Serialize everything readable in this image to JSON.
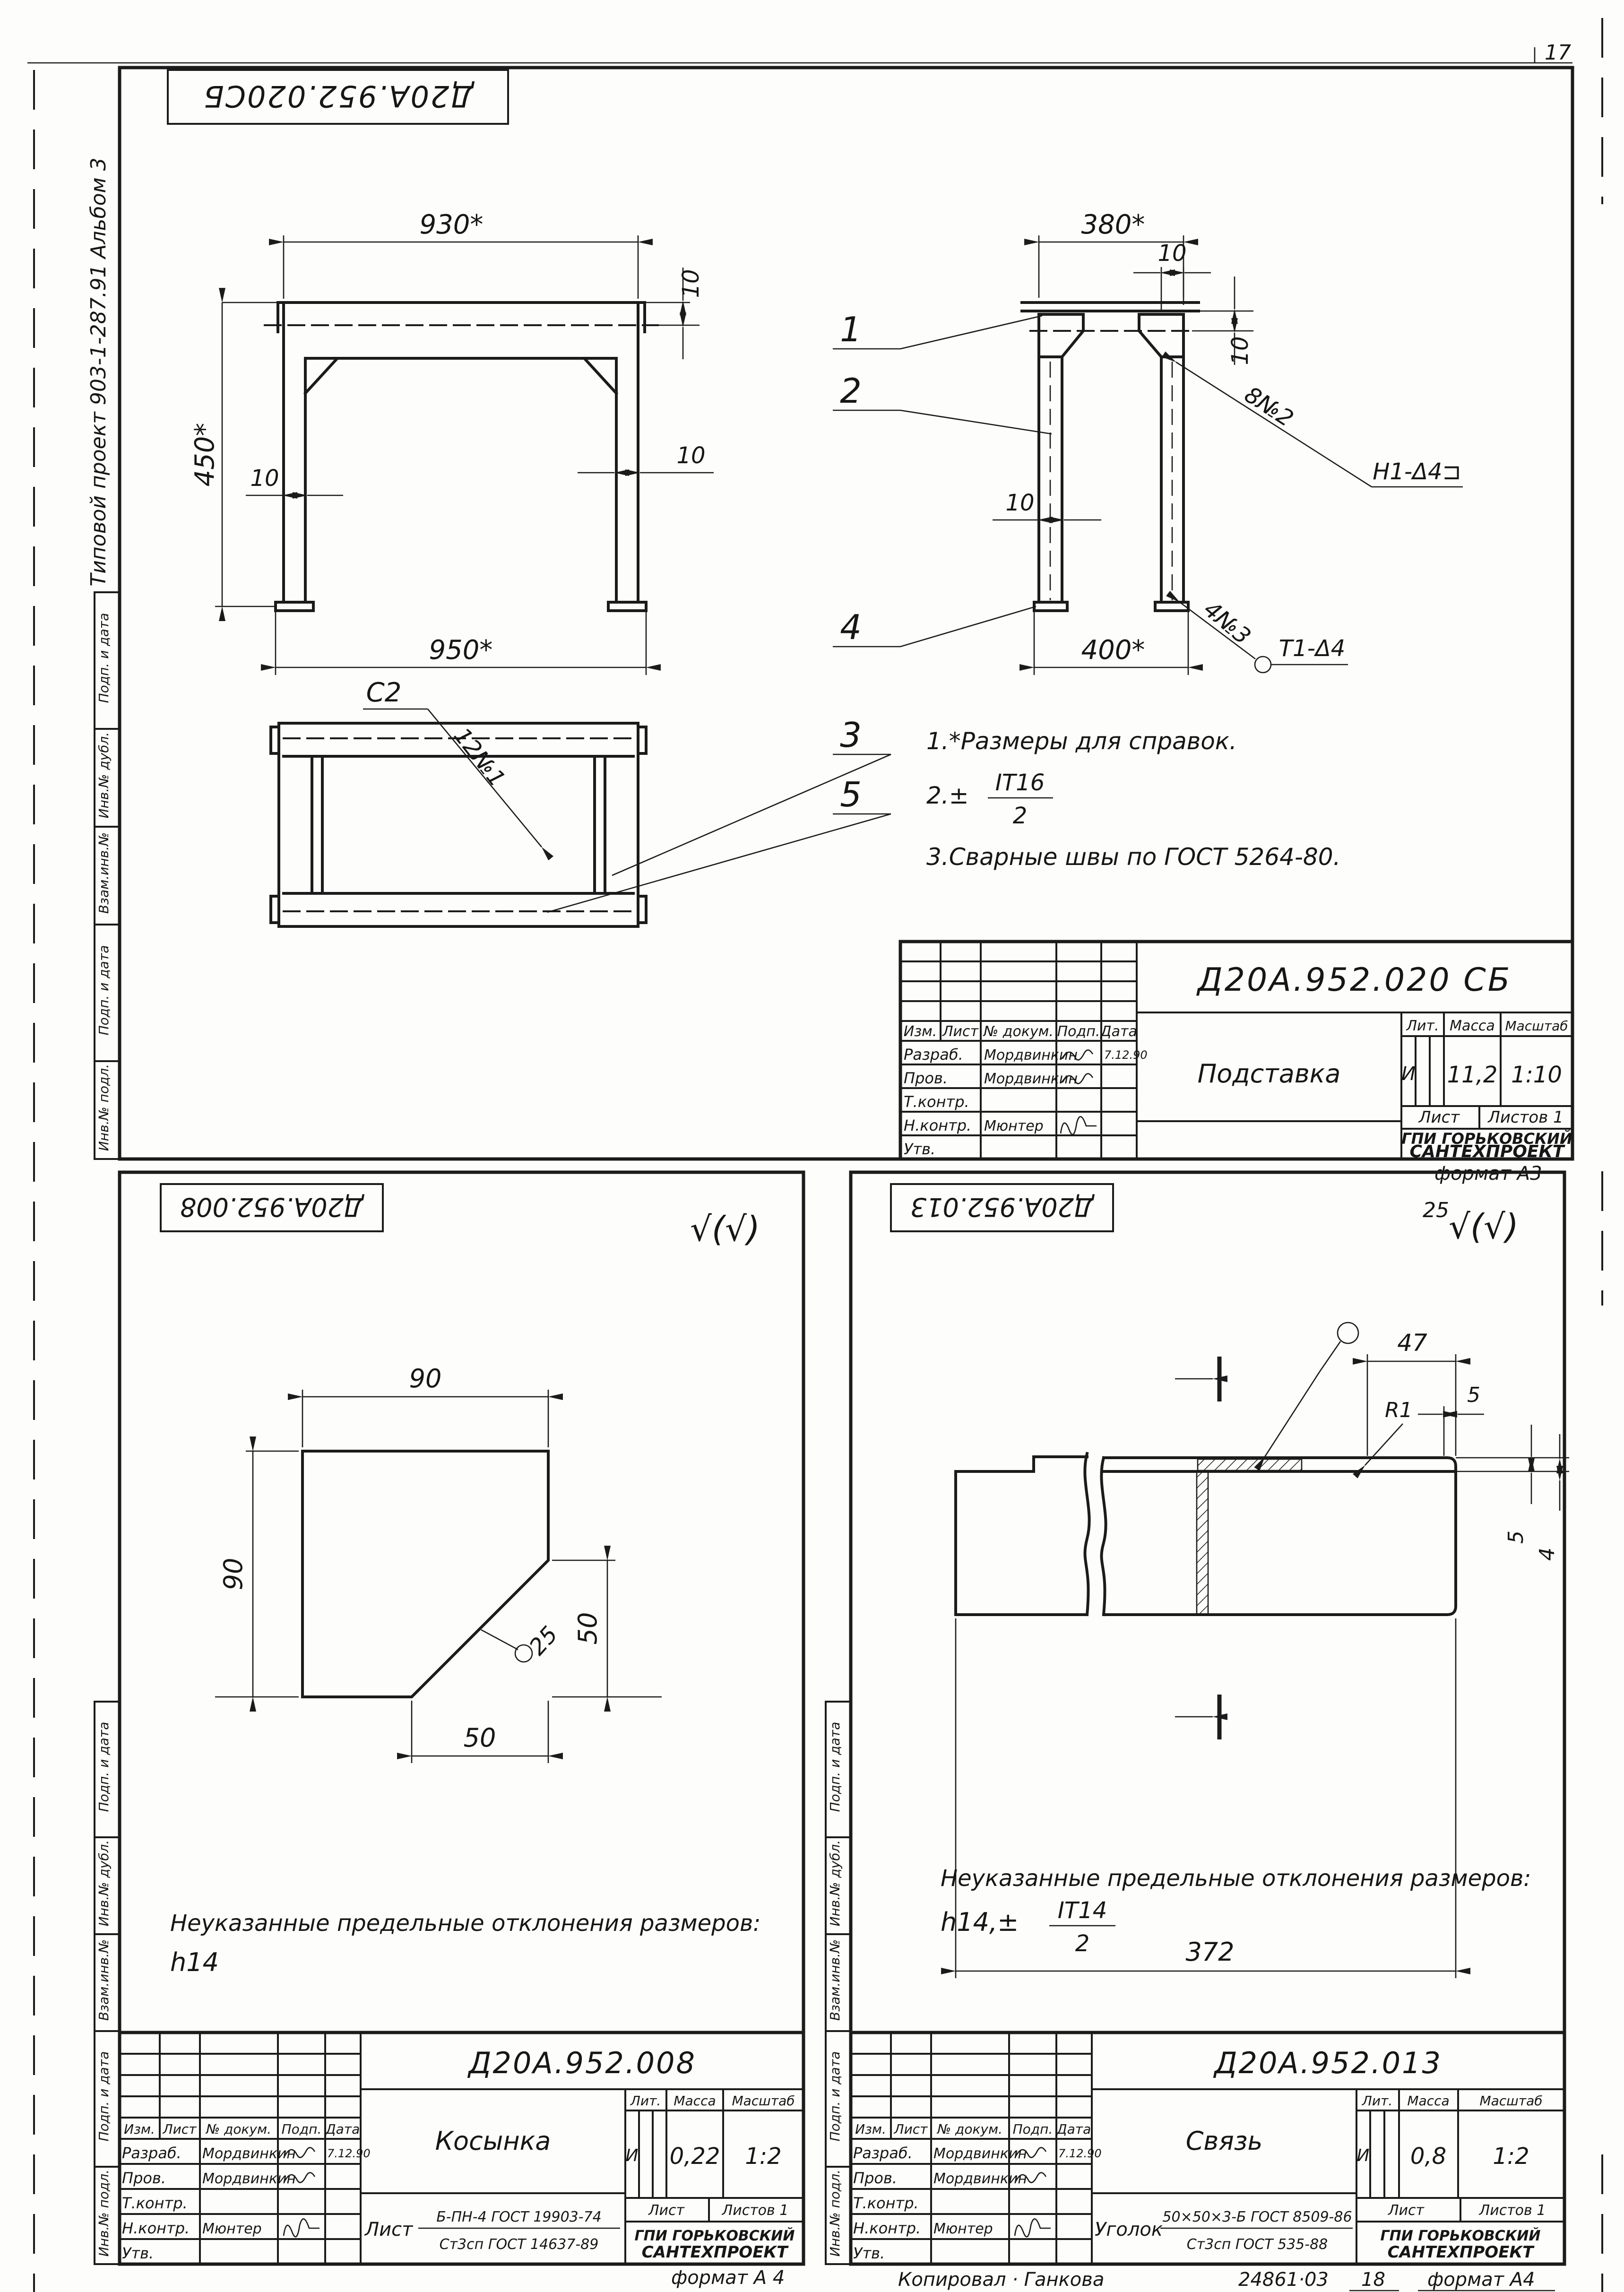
{
  "page": {
    "number": "17",
    "format_a3": "формат А3",
    "format_a4_left": "формат А 4",
    "format_a4_right": "формат А4",
    "copied": "Копировал · Ганкова",
    "footer_num": "24861·03",
    "footer_num2": "18"
  },
  "margin_block": {
    "cells": [
      "Подп. и дата",
      "Инв.№ дубл.",
      "Взам.инв.№",
      "Подп. и дата",
      "Инв.№ подл."
    ]
  },
  "side_texts": {
    "album": "Альбом 3",
    "project": "Типовой проект 903-1-287.91"
  },
  "common": {
    "header": {
      "izm": "Изм.",
      "list": "Лист",
      "doc": "№ докум.",
      "sign": "Подп.",
      "date": "Дата"
    },
    "roles": {
      "razrab": "Разраб.",
      "prov": "Пров.",
      "tkontr": "Т.контр.",
      "nkontr": "Н.контр.",
      "utv": "Утв."
    },
    "labels": {
      "lit": "Лит.",
      "mass": "Масса",
      "scale": "Масштаб",
      "sheet": "Лист",
      "sheets": "Листов 1"
    },
    "names": {
      "designer": "Мордвинкин",
      "checker": "Мордвинкин",
      "ncontrol": "Мюнтер"
    },
    "date": "7.12.90",
    "lit_value": "И",
    "org_line1": "ГПИ ГОРЬКОВСКИЙ",
    "org_line2": "САНТЕХПРОЕКТ"
  },
  "sheet_top": {
    "stamp": "Д20А.952.020СБ",
    "doc": "Д20А.952.020 СБ",
    "title": "Подставка",
    "mass": "11,2",
    "scale": "1:10",
    "front": {
      "w_top": "930*",
      "height": "450*",
      "w_bot": "950*",
      "t_leg_l": "10",
      "t_beam": "10",
      "t_leg_r": "10"
    },
    "side": {
      "w_top": "380*",
      "w_bot": "400*",
      "t_top": "10",
      "t_beam": "10",
      "t_leg": "10"
    },
    "plan": {
      "weld_c2": "С2",
      "weld_12": "12№1"
    },
    "callouts": {
      "c1": "1",
      "c2": "2",
      "c3": "3",
      "c4": "4",
      "c5": "5"
    },
    "welds": {
      "w1": "8№2",
      "w1_ref": "Н1-Δ4⊐",
      "w2": "4№3",
      "w2_ref": "Т1-Δ4"
    },
    "notes": {
      "n1": "1.*Размеры для справок.",
      "n2_pre": "2.±",
      "n2_num": "IT16",
      "n2_den": "2",
      "n3": "3.Сварные швы по ГОСТ 5264-80."
    }
  },
  "sheet_left": {
    "stamp": "Д20А.952.008",
    "doc": "Д20А.952.008",
    "title": "Косынка",
    "mass": "0,22",
    "scale": "1:2",
    "rough": "√(√)",
    "dims": {
      "w": "90",
      "h": "90",
      "c_v": "50",
      "c_h": "50",
      "thk": "25"
    },
    "note1": "Неуказанные предельные отклонения размеров:",
    "note2": "h14",
    "material": {
      "prefix": "Лист",
      "top": "Б-ПН-4 ГОСТ 19903-74",
      "bottom": "Ст3сп ГОСТ 14637-89"
    }
  },
  "sheet_right": {
    "stamp": "Д20А.952.013",
    "doc": "Д20А.952.013",
    "title": "Связь",
    "mass": "0,8",
    "scale": "1:2",
    "rough_num": "25",
    "rough": "√(√)",
    "dims": {
      "len": "372",
      "a": "47",
      "b": "5",
      "c": "5",
      "d": "4",
      "r": "R1"
    },
    "note1": "Неуказанные предельные отклонения размеров:",
    "note2_pre": "h14,±",
    "note2_num": "IT14",
    "note2_den": "2",
    "material": {
      "prefix": "Уголок",
      "top": "50×50×3-Б ГОСТ 8509-86",
      "bottom": "Ст3сп  ГОСТ 535-88"
    }
  }
}
